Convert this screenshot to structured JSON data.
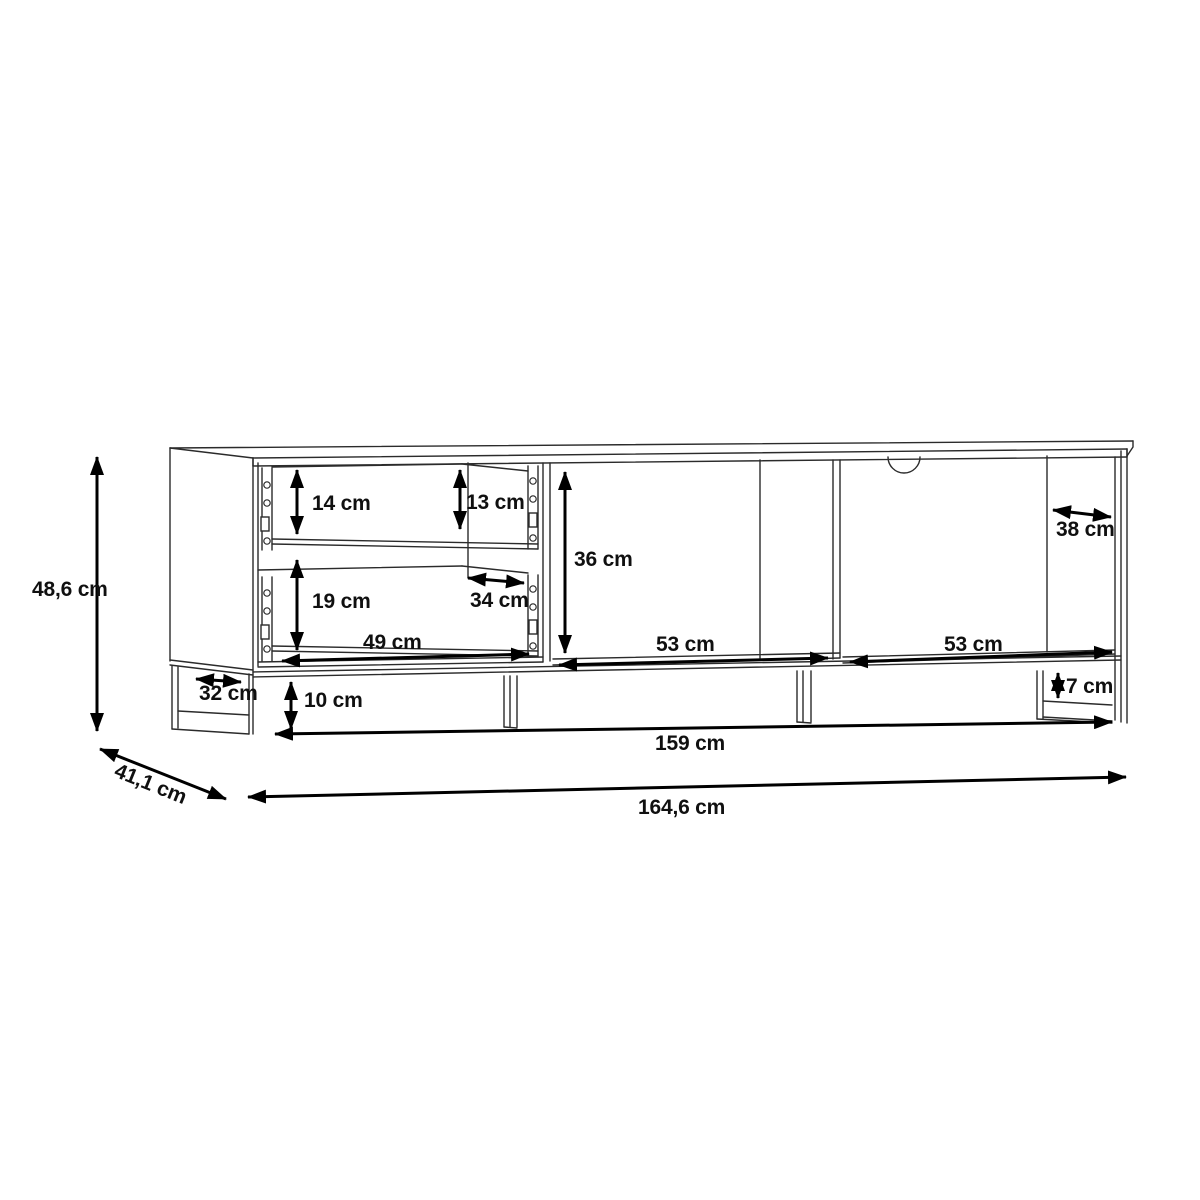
{
  "diagram": {
    "type": "furniture dimensional technical drawing",
    "subject": "TV lowboard with two open drawers, two open compartments, cable hole and sled legs",
    "unit": "cm",
    "colors": {
      "background": "#ffffff",
      "drawing_line": "#2b2b2b",
      "dimension_line": "#000000",
      "label_text": "#101010"
    },
    "labels": {
      "overall_height": "48,6 cm",
      "overall_depth": "41,1 cm",
      "overall_width": "164,6 cm",
      "base_width": "159 cm",
      "top_drawer_front_height": "14 cm",
      "top_drawer_back_height": "13 cm",
      "bottom_drawer_height": "19 cm",
      "drawer_inner_depth": "34 cm",
      "drawer_inner_width": "49 cm",
      "compartment_height": "36 cm",
      "middle_compartment_width": "53 cm",
      "right_compartment_width": "53 cm",
      "compartment_depth": "38 cm",
      "left_leg_width": "32 cm",
      "leg_height": "10 cm",
      "right_leg_clearance": "7 cm"
    }
  }
}
